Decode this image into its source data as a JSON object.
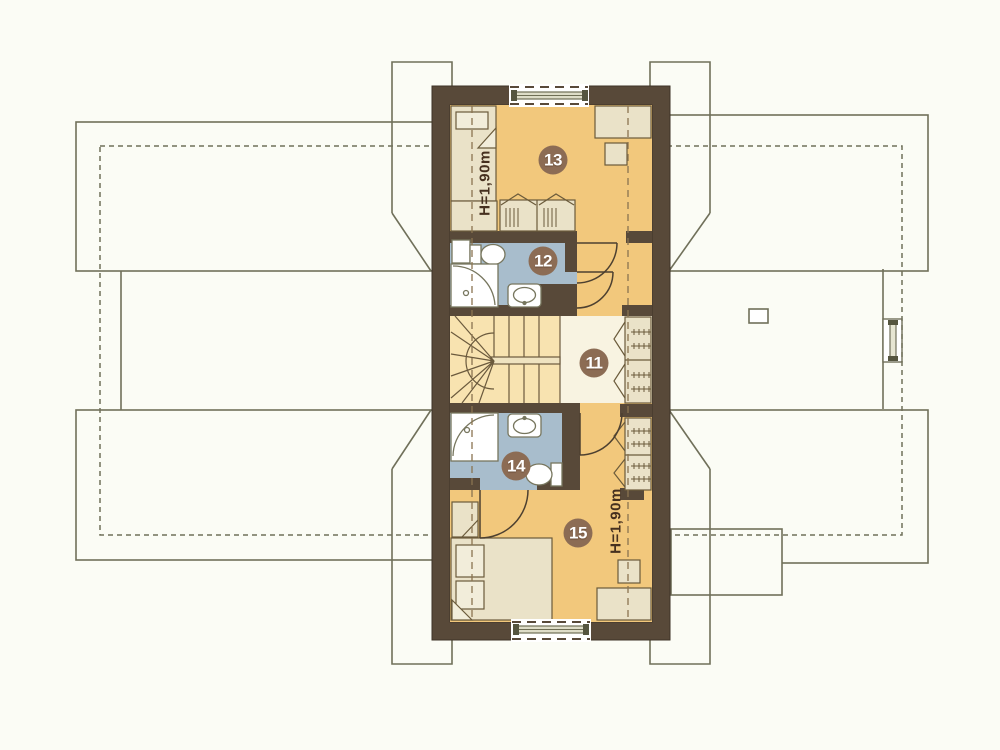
{
  "plan": {
    "title": "attic floor plan",
    "rooms": [
      {
        "number": "13",
        "kind": "bedroom",
        "height_note": "H=1,90m"
      },
      {
        "number": "12",
        "kind": "bathroom"
      },
      {
        "number": "11",
        "kind": "hall-stairs"
      },
      {
        "number": "14",
        "kind": "bathroom"
      },
      {
        "number": "15",
        "kind": "bedroom",
        "height_note": "H=1,90m"
      }
    ],
    "colors": {
      "wall": "#584939",
      "floor_orange": "#f2c87c",
      "floor_cream": "#f8f3e1",
      "floor_stair": "#f8e3b0",
      "floor_bath": "#a8bdcc",
      "furniture": "#eae2c8",
      "roof_line": "#70705a",
      "badge": "#8c6c54",
      "label_text": "#46301f",
      "background": "#fbfcf5"
    }
  }
}
